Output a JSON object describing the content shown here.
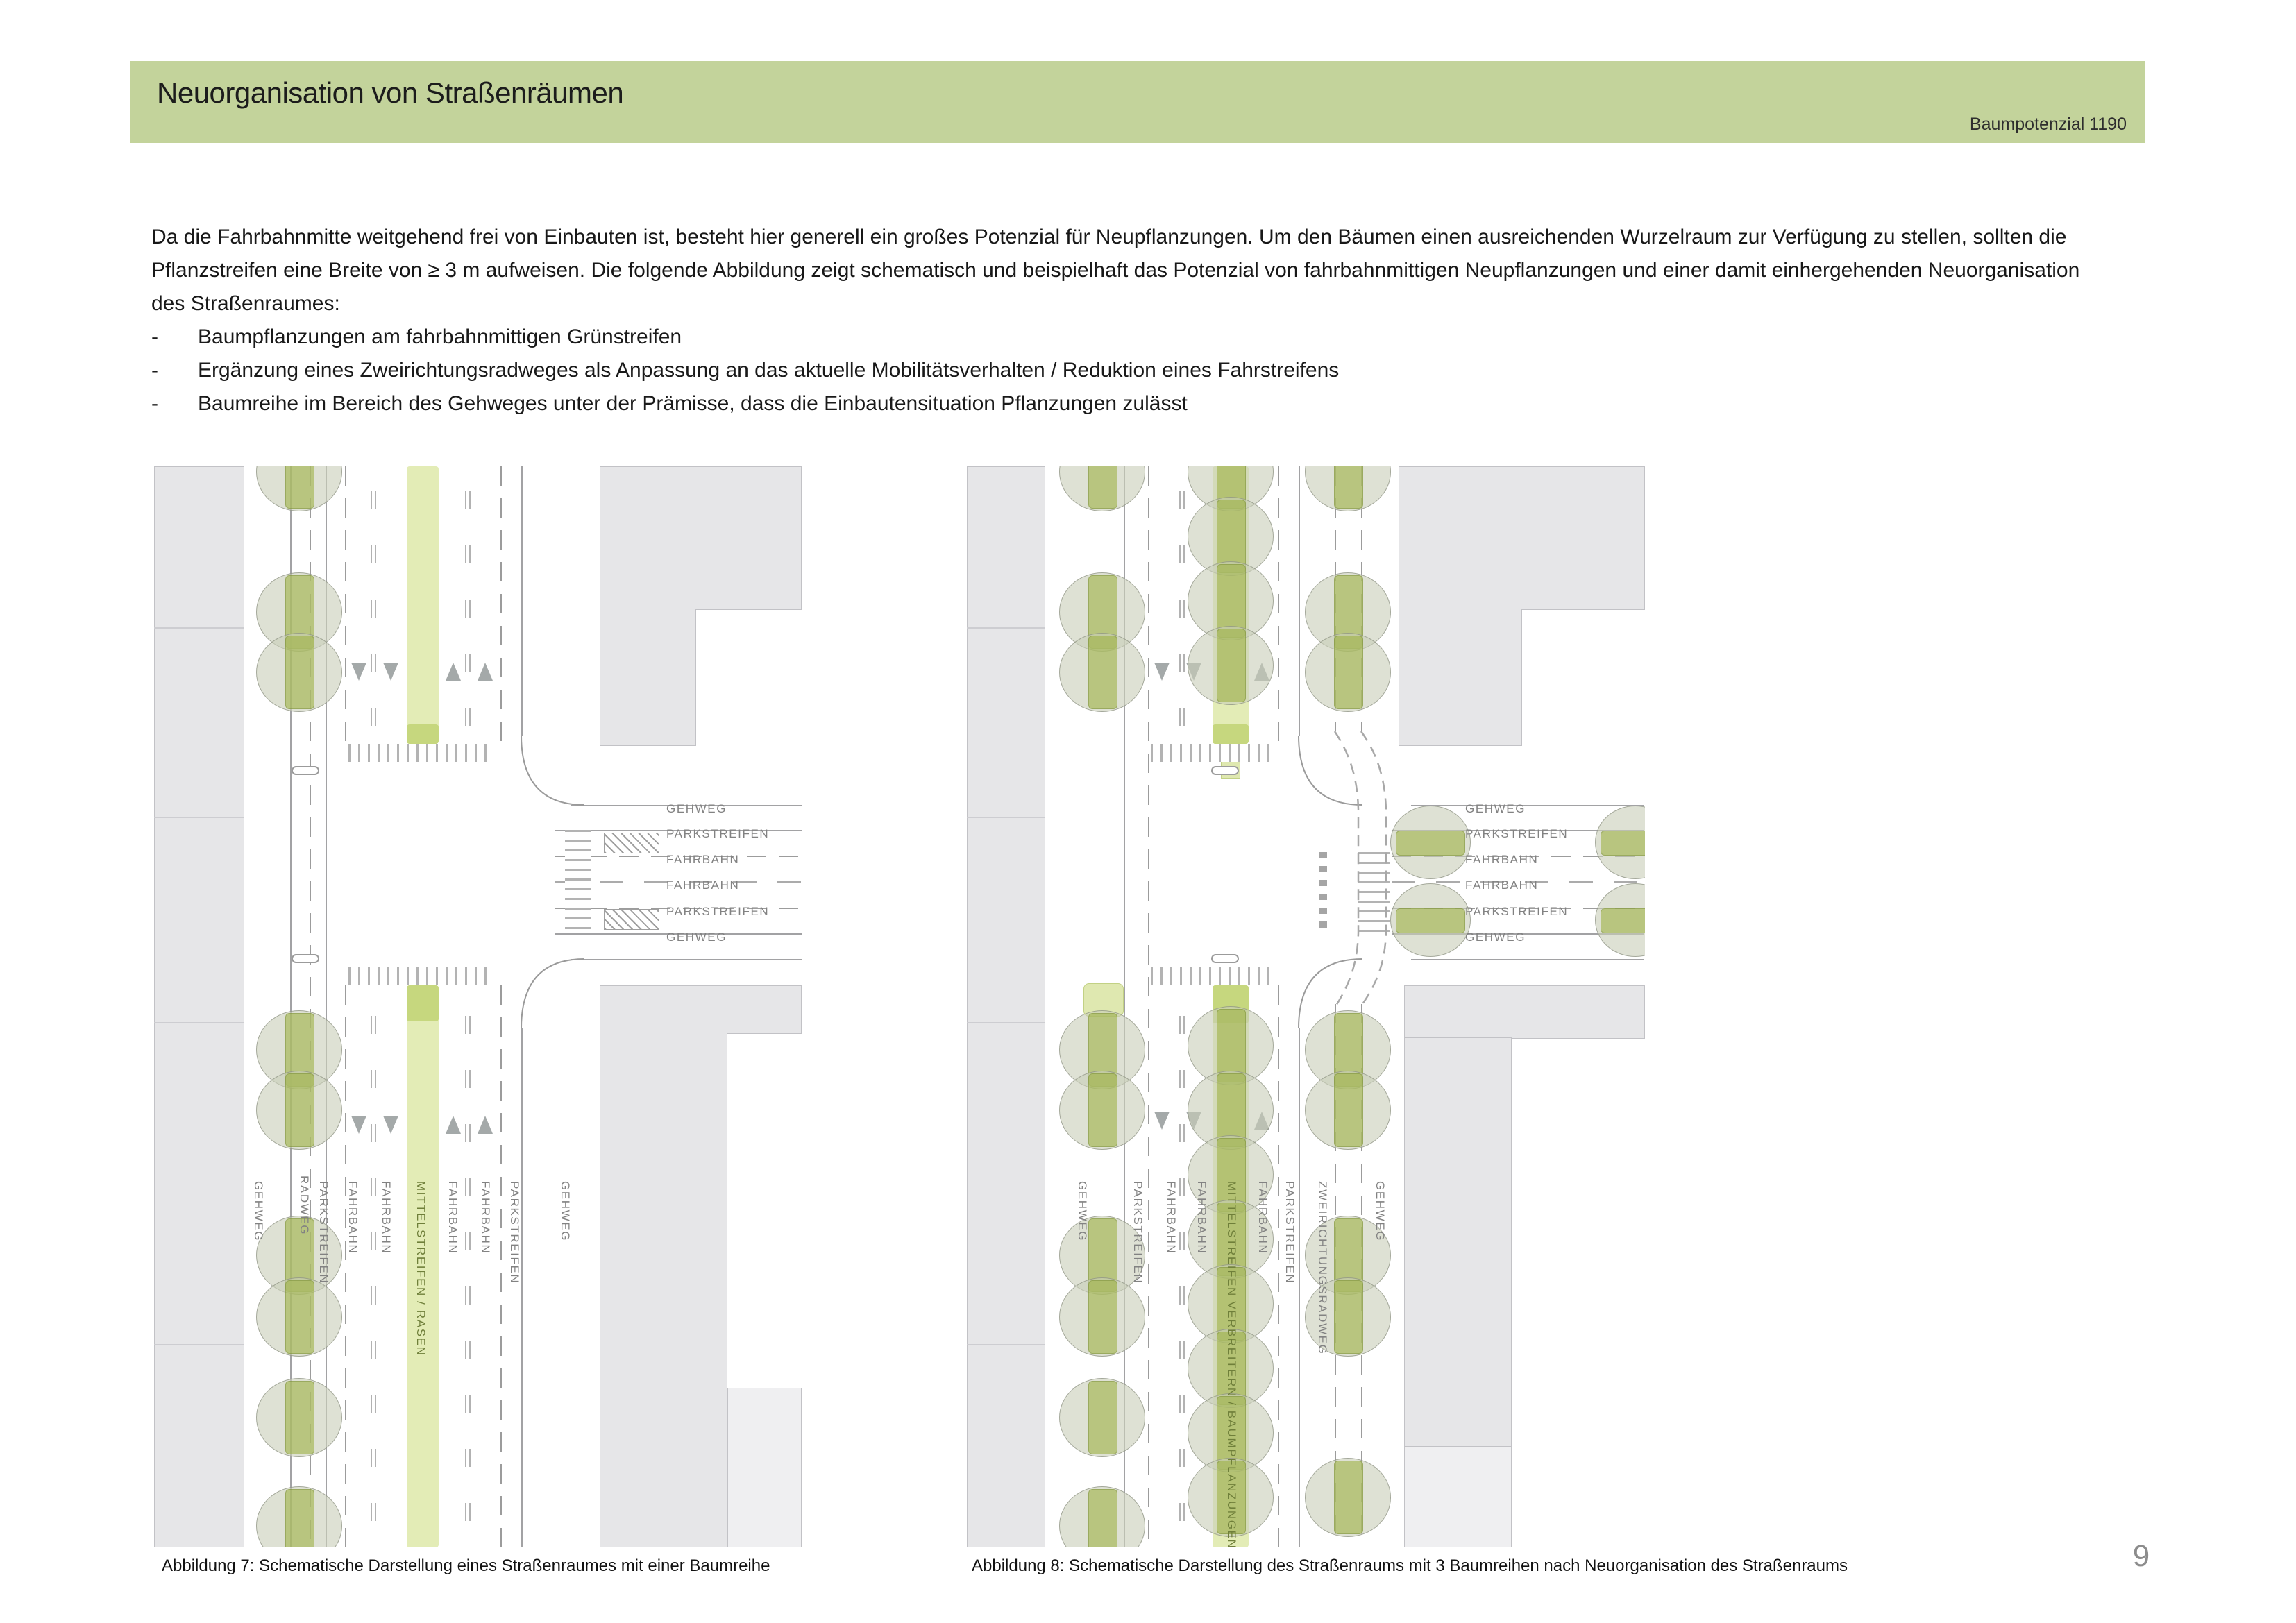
{
  "header": {
    "title": "Neuorganisation von Straßenräumen",
    "right_label": "Baumpotenzial 1190"
  },
  "intro": {
    "paragraph": "Da die Fahrbahnmitte weitgehend frei von Einbauten ist, besteht hier generell ein großes Potenzial für Neupflanzungen. Um den Bäumen einen ausreichenden Wurzelraum zur Verfügung zu stellen, sollten die Pflanzstreifen eine Breite von ≥ 3 m aufweisen. Die folgende Abbildung zeigt schematisch und beispielhaft das Potenzial von fahrbahnmittigen Neupflanzungen und einer damit einhergehenden Neuorganisation des Straßenraumes:",
    "bullet_dash": "-",
    "bullets": [
      "Baumpflanzungen am fahrbahnmittigen Grünstreifen",
      "Ergänzung eines Zweirichtungsradweges als Anpassung an das aktuelle Mobilitätsverhalten / Reduktion eines Fahrstreifens",
      "Baumreihe im Bereich des Gehweges unter der Prämisse, dass die Einbautensituation Pflanzungen zulässt"
    ]
  },
  "fig7": {
    "caption": "Abbildung 7: Schematische Darstellung eines Straßenraumes mit einer Baumreihe",
    "street_labels": [
      "GEHWEG",
      "RADWEG",
      "PARKSTREIFEN",
      "FAHRBAHN",
      "FAHRBAHN",
      "MITTELSTREIFEN / RASEN",
      "FAHRBAHN",
      "FAHRBAHN",
      "PARKSTREIFEN",
      "GEHWEG"
    ],
    "cross_labels": [
      "GEHWEG",
      "PARKSTREIFEN",
      "FAHRBAHN",
      "FAHRBAHN",
      "PARKSTREIFEN",
      "GEHWEG"
    ]
  },
  "fig8": {
    "caption": "Abbildung 8: Schematische Darstellung des Straßenraums mit 3 Baumreihen nach Neuorganisation des Straßenraums",
    "street_labels": [
      "GEHWEG",
      "PARKSTREIFEN",
      "FAHRBAHN",
      "FAHRBAHN",
      "MITTELSTREIFEN VERBREITERN / BAUMPFLANZUNGEN",
      "FAHRBAHN",
      "PARKSTREIFEN",
      "ZWEIRICHTUNGSRADWEG",
      "GEHWEG"
    ],
    "cross_labels": [
      "GEHWEG",
      "PARKSTREIFEN",
      "FAHRBAHN",
      "FAHRBAHN",
      "PARKSTREIFEN",
      "GEHWEG"
    ]
  },
  "page_number": "9",
  "colors": {
    "header_bar": "#c3d39b",
    "median_green": "#e3ecb6",
    "median_cap_green": "#c6d77e",
    "tree_band_green": "#9cb142",
    "building_gray": "#e6e6e8",
    "line_gray": "#a2a2a4",
    "label_gray": "#828282"
  }
}
